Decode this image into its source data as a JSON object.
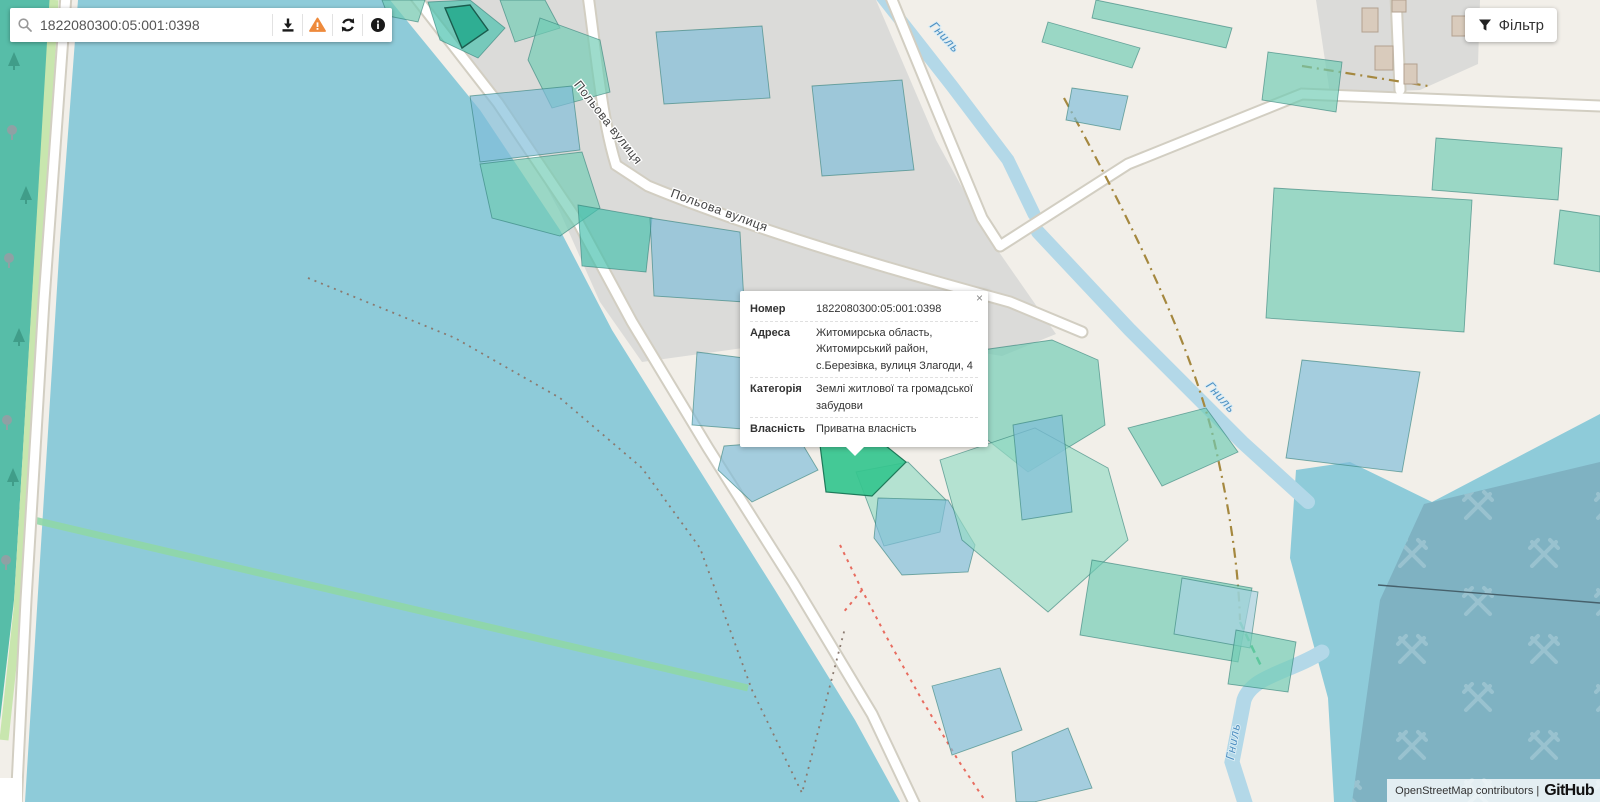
{
  "search": {
    "value": "1822080300:05:001:0398",
    "icons": {
      "search": "magnifier",
      "download": "download-arrow-tray",
      "warning": "orange-warning-triangle",
      "refresh": "circular-arrows",
      "info": "info-circle"
    }
  },
  "filter": {
    "label": "Фільтр",
    "icon": "funnel"
  },
  "popup": {
    "close_label": "×",
    "rows": [
      {
        "label": "Номер",
        "value": "1822080300:05:001:0398"
      },
      {
        "label": "Адреса",
        "value": "Житомирська область, Житомирський район, с.Березівка, вулиця Злагоди, 4"
      },
      {
        "label": "Категорія",
        "value": "Землі житлової та громадської забудови"
      },
      {
        "label": "Власність",
        "value": "Приватна власність"
      }
    ]
  },
  "map": {
    "street_labels": [
      {
        "text": "Польова вулиця"
      },
      {
        "text": "Польова вулиця"
      }
    ],
    "river_labels": [
      {
        "text": "Гниль"
      },
      {
        "text": "Гниль"
      },
      {
        "text": "Гниль"
      }
    ],
    "colors": {
      "land": "#f2efe9",
      "urban": "#dbdbd9",
      "water": "#8ecbd9",
      "river": "#b3d8e8",
      "forest": "#57bda8",
      "quarry": "#7fb2c2",
      "parcel_teal": "#70ccb4",
      "parcel_blue": "#7fbdd9",
      "selected_parcel": "#35c58e",
      "warning_orange": "#ee8a3c"
    }
  },
  "attribution": {
    "text": "OpenStreetMap contributors |",
    "brand": "GitHub"
  }
}
